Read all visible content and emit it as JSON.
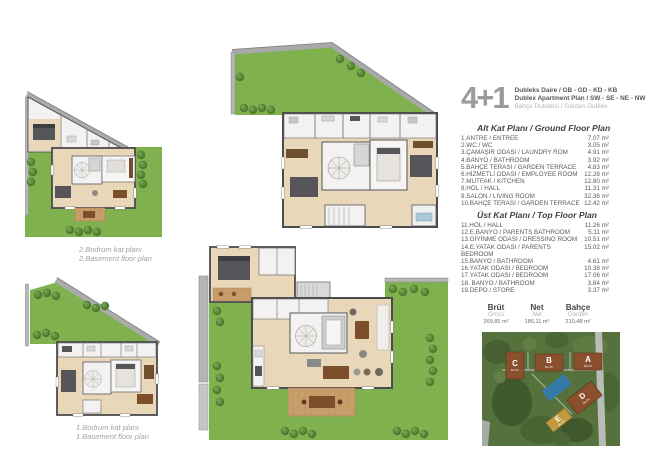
{
  "header": {
    "unit_type": "4+1",
    "line1": "Dubleks Daire / GB - GD - KD - KB",
    "line2": "Dublex Apartment Plan / SW - SE - NE - NW",
    "line3": "Bahçe Dubleksi / Garden Dublex"
  },
  "ground_floor": {
    "title": "Alt Kat Planı / Ground Floor Plan",
    "rooms": [
      {
        "name": "1.ANTRE / ENTREE",
        "area": "7.07 m²"
      },
      {
        "name": "2.WC / WC",
        "area": "3.05 m²"
      },
      {
        "name": "3.ÇAMAŞIR ODASI / LAUNDRY ROM",
        "area": "4.91 m²"
      },
      {
        "name": "4.BANYO / BATHROOM",
        "area": "3.92 m²"
      },
      {
        "name": "5.BAHÇE TERASI / GARDEN TERRACE",
        "area": "4.83 m²"
      },
      {
        "name": "6.HİZMETLİ ODASI / EMPLOYEE ROOM",
        "area": "12.28 m²"
      },
      {
        "name": "7.MUTFAK / KITCHEN",
        "area": "12.80 m²"
      },
      {
        "name": "8.HOL / HALL",
        "area": "11.31 m²"
      },
      {
        "name": "9.SALON / LIVING ROOM",
        "area": "32.36 m²"
      },
      {
        "name": "10.BAHÇE TERASI / GARDEN TERRACE",
        "area": "12.42 m²"
      }
    ]
  },
  "top_floor": {
    "title": "Üst Kat Planı / Top Floor Plan",
    "rooms": [
      {
        "name": "11.HOL / HALL",
        "area": "11.26 m²"
      },
      {
        "name": "12.E.BANYO / PARENTS BATHROOM",
        "area": "5.11 m²"
      },
      {
        "name": "13.GİYİNME ODASI / DRESSING ROOM",
        "area": "10.51 m²"
      },
      {
        "name": "14.E.YATAK ODASI / PARENTS BEDROOM",
        "area": "15.02 m²"
      },
      {
        "name": "15.BANYO / BATHROOM",
        "area": "4.61 m²"
      },
      {
        "name": "16.YATAK ODASI / BEDROOM",
        "area": "10.38 m²"
      },
      {
        "name": "17.YATAK ODASI / BEDROOM",
        "area": "17.06 m²"
      },
      {
        "name": "18. BANYO / BATHROOM",
        "area": "3.84 m²"
      },
      {
        "name": "19.DEPO / STORE",
        "area": "3.37 m²"
      }
    ]
  },
  "summary": {
    "columns": [
      {
        "label": "Brüt",
        "sublabel": "Gross",
        "value": "269,85 m²"
      },
      {
        "label": "Net",
        "sublabel": "Net",
        "value": "186,11 m²"
      },
      {
        "label": "Bahçe",
        "sublabel": "Garden",
        "value": "210,48 m²"
      }
    ]
  },
  "captions": {
    "basement2_line1": "2.Bodrum kat planı",
    "basement2_line2": "2.Basement floor plan",
    "basement1_line1": "1.Bodrum kat planı",
    "basement1_line2": "1.Basement floor plan"
  },
  "site_plan": {
    "blocks": [
      {
        "label": "C",
        "sub": "BLOK"
      },
      {
        "label": "B",
        "sub": "BLOK"
      },
      {
        "label": "A",
        "sub": "BLOK"
      },
      {
        "label": "D",
        "sub": "BLOK"
      },
      {
        "label": "E",
        "sub": "BLOK"
      }
    ]
  },
  "colors": {
    "garden_green": "#7fb24f",
    "tree_green": "#4c7a2e",
    "wood_floor": "#e9d7ba",
    "deck_wood": "#c79d6a",
    "wall_dark": "#4c4c4e",
    "retaining_gray": "#adadad",
    "unit_gray": "#9b9b9d",
    "text_dark": "#58585a",
    "text_light": "#b4b4b6",
    "block_brown": "#8a4f2c",
    "block_yellow": "#c19a3f",
    "pool_blue": "#3579a8"
  }
}
